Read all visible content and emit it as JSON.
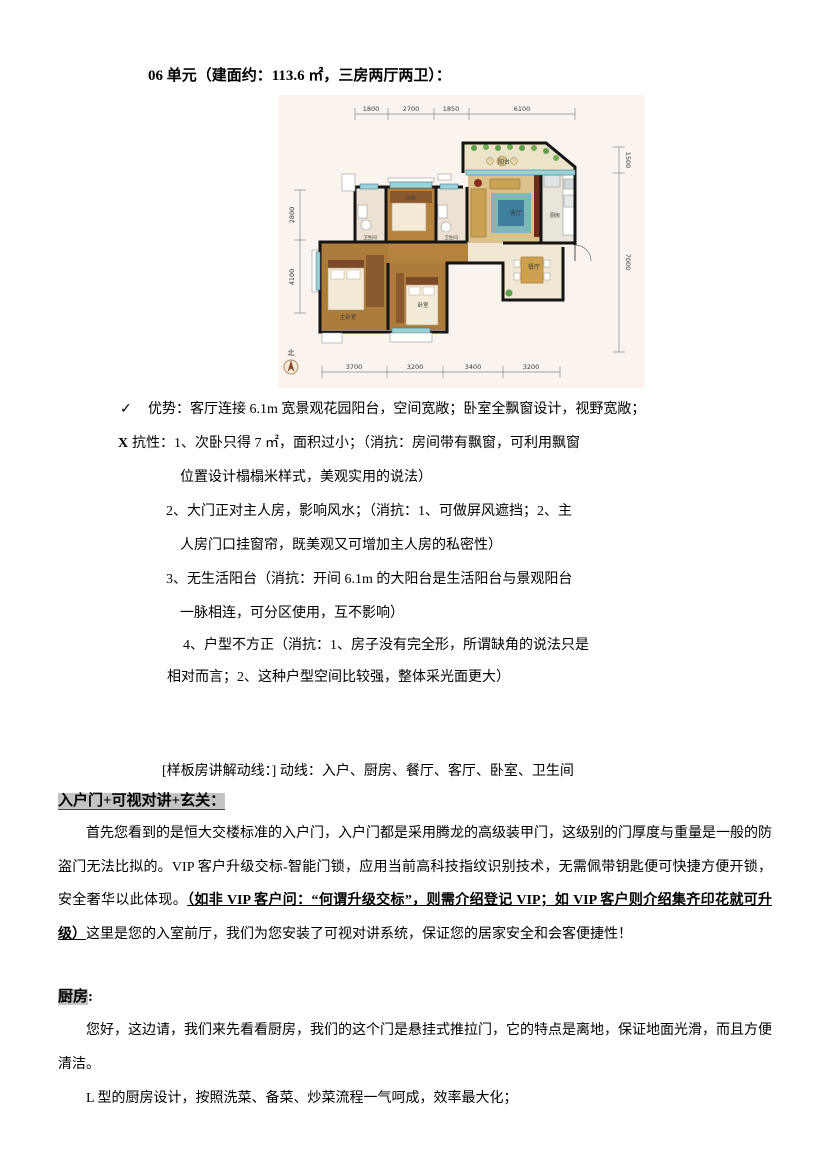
{
  "title": "06 单元（建面约：113.6 ㎡，三房两厅两卫）：",
  "analysis": {
    "advantage_mark": "✓",
    "advantage": "优势：客厅连接 6.1m 宽景观花园阳台，空间宽敞；卧室全飘窗设计，视野宽敞；",
    "resistance_mark": "X",
    "res1a": "抗性：1、次卧只得 7 ㎡，面积过小；（消抗：房间带有飘窗，可利用飘窗",
    "res1b": "位置设计榻榻米样式，美观实用的说法）",
    "res2a": "2、大门正对主人房，影响风水；（消抗：1、可做屏风遮挡；2、主",
    "res2b": "人房门口挂窗帘，既美观又可增加主人房的私密性）",
    "res3a": "3、无生活阳台（消抗：开间 6.1m 的大阳台是生活阳台与景观阳台",
    "res3b": "一脉相连，可分区使用，互不影响）",
    "res4a": "4、户型不方正（消抗：1、房子没有完全形，所谓缺角的说法只是",
    "res4b": "相对而言；2、这种户型空间比较强，整体采光面更大）"
  },
  "tour_line": "[样板房讲解动线：] 动线：入户、厨房、餐厅、客厅、卧室、卫生间",
  "sections": {
    "entry": {
      "heading": "入户门+可视对讲+玄关：",
      "para_start": "首先您看到的是恒大交楼标准的入户门，入户门都是采用腾龙的高级装甲门，这级别的门厚度与重量是一般的防盗门无法比拟的。VIP 客户升级交标-智能门锁，应用当前高科技指纹识别技术，无需佩带钥匙便可快捷方便开锁，安全奢华以此体现。",
      "para_underline": "（如非 VIP 客户问：“何谓升级交标”，则需介绍登记 VIP；如 VIP 客户则介绍集齐印花就可升级）",
      "para_end": "这里是您的入室前厅，我们为您安装了可视对讲系统，保证您的居家安全和会客便捷性！"
    },
    "kitchen": {
      "heading": "厨房",
      "heading_colon": ":",
      "para1": "您好，这边请，我们来先看看厨房，我们的这个门是悬挂式推拉门，它的特点是离地，保证地面光滑，而且方便清洁。",
      "para2": "L 型的厨房设计，按照洗菜、备菜、炒菜流程一气呵成，效率最大化；"
    }
  },
  "floorplan": {
    "dims_top": [
      "1800",
      "2700",
      "1850",
      "6100"
    ],
    "dims_right": [
      "1500",
      "7000"
    ],
    "dims_left": [
      "2800",
      "4100"
    ],
    "dims_bottom": [
      "3700",
      "3200",
      "3400",
      "3200"
    ],
    "north_label": "北",
    "rooms": {
      "balcony": "阳台",
      "living": "客厅",
      "kitchen": "厨房",
      "dining": "餐厅",
      "bedroom2": "次卧",
      "bath1": "卫生间",
      "bath2": "卫生间",
      "master": "主卧室",
      "bedroom": "卧室"
    },
    "colors": {
      "wall": "#141414",
      "wood": "#ad7c3a",
      "tile": "#f0e7d4",
      "window": "#9ad2da",
      "paper": "#fbf3ed"
    }
  }
}
